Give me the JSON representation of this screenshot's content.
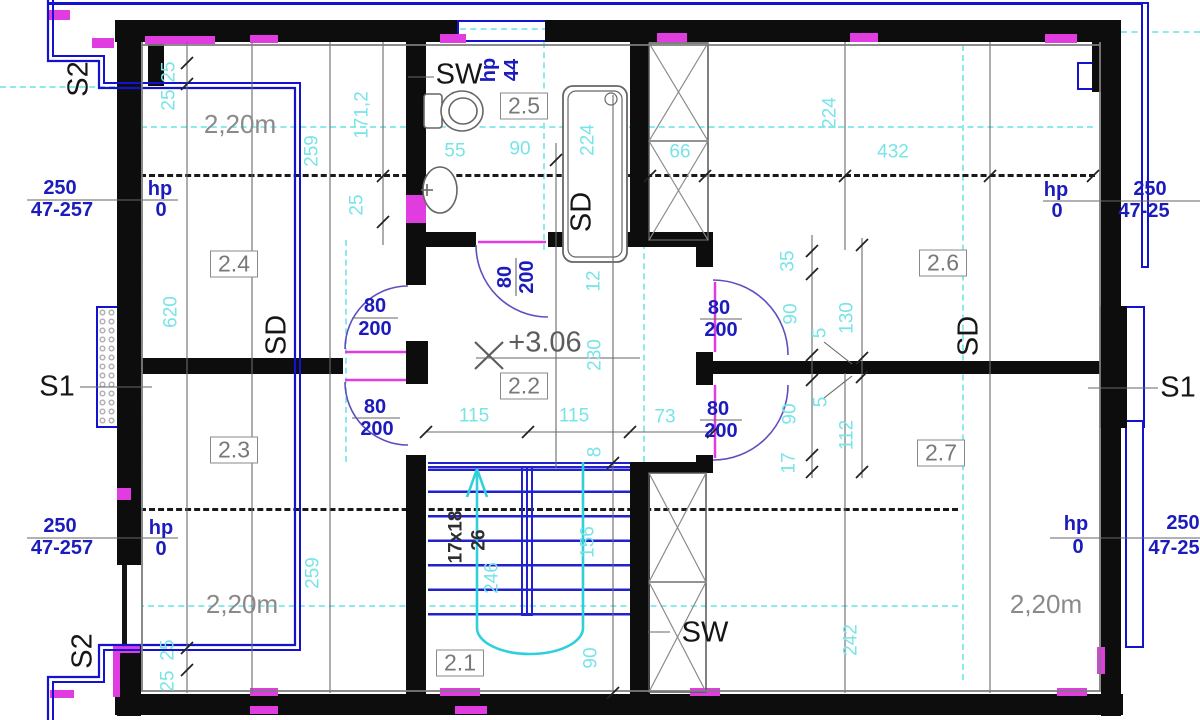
{
  "drawing": {
    "kind": "floor plan (upper storey)",
    "level_marker": "+3.06",
    "stair_note": "17x18",
    "stair_going": "26"
  },
  "rooms": [
    {
      "id": "2.1"
    },
    {
      "id": "2.2"
    },
    {
      "id": "2.3"
    },
    {
      "id": "2.4"
    },
    {
      "id": "2.5"
    },
    {
      "id": "2.6"
    },
    {
      "id": "2.7"
    }
  ],
  "section_markers": {
    "s1": "S1",
    "s2": "S2"
  },
  "wall_labels": {
    "sw": "SW",
    "sd": "SD"
  },
  "colors": {
    "wall": "#0d0d0d",
    "dim_cyan": "#79e4e8",
    "blue_text": "#1c1cbc",
    "magenta": "#e03ce0",
    "door_arc": "#5d4fc0",
    "gray_text": "#8a8a8a",
    "walkline": "#2fd0dc",
    "window_blue": "#1313cf"
  },
  "labels": [
    {
      "n": "dim-label",
      "t": "25",
      "x": 169,
      "y": 72,
      "r": -90,
      "c": "dim"
    },
    {
      "n": "dim-label",
      "t": "25",
      "x": 169,
      "y": 100,
      "r": -90,
      "c": "dim"
    },
    {
      "n": "dim-label",
      "t": "171,2",
      "x": 362,
      "y": 115,
      "r": -90,
      "c": "dim"
    },
    {
      "n": "dim-label",
      "t": "25",
      "x": 357,
      "y": 205,
      "r": -90,
      "c": "dim"
    },
    {
      "n": "dim-label",
      "t": "259",
      "x": 312,
      "y": 151,
      "r": -90,
      "c": "dim"
    },
    {
      "n": "dim-label",
      "t": "620",
      "x": 171,
      "y": 312,
      "r": -90,
      "c": "dim"
    },
    {
      "n": "dim-label",
      "t": "259",
      "x": 313,
      "y": 573,
      "r": -90,
      "c": "dim"
    },
    {
      "n": "dim-label",
      "t": "25",
      "x": 168,
      "y": 650,
      "r": -90,
      "c": "dim"
    },
    {
      "n": "dim-label",
      "t": "25",
      "x": 168,
      "y": 681,
      "r": -90,
      "c": "dim"
    },
    {
      "n": "dim-label",
      "t": "55",
      "x": 455,
      "y": 151,
      "r": 0,
      "c": "dim"
    },
    {
      "n": "dim-label",
      "t": "90",
      "x": 520,
      "y": 149,
      "r": 0,
      "c": "dim"
    },
    {
      "n": "dim-label",
      "t": "224",
      "x": 588,
      "y": 140,
      "r": -90,
      "c": "dim"
    },
    {
      "n": "dim-label",
      "t": "66",
      "x": 680,
      "y": 152,
      "r": 0,
      "c": "dim"
    },
    {
      "n": "dim-label",
      "t": "224",
      "x": 830,
      "y": 113,
      "r": -90,
      "c": "dim"
    },
    {
      "n": "dim-label",
      "t": "432",
      "x": 893,
      "y": 152,
      "r": 0,
      "c": "dim"
    },
    {
      "n": "dim-label",
      "t": "12",
      "x": 594,
      "y": 281,
      "r": -90,
      "c": "dim"
    },
    {
      "n": "dim-label",
      "t": "230",
      "x": 595,
      "y": 355,
      "r": -90,
      "c": "dim"
    },
    {
      "n": "dim-label",
      "t": "8",
      "x": 595,
      "y": 452,
      "r": -90,
      "c": "dim"
    },
    {
      "n": "dim-label",
      "t": "115",
      "x": 474,
      "y": 416,
      "r": 0,
      "c": "dim"
    },
    {
      "n": "dim-label",
      "t": "115",
      "x": 574,
      "y": 416,
      "r": 0,
      "c": "dim"
    },
    {
      "n": "dim-label",
      "t": "73",
      "x": 665,
      "y": 417,
      "r": 0,
      "c": "dim"
    },
    {
      "n": "dim-label",
      "t": "35",
      "x": 788,
      "y": 261,
      "r": -90,
      "c": "dim"
    },
    {
      "n": "dim-label",
      "t": "90",
      "x": 791,
      "y": 314,
      "r": -90,
      "c": "dim"
    },
    {
      "n": "dim-label",
      "t": "5",
      "x": 820,
      "y": 333,
      "r": -90,
      "c": "dim"
    },
    {
      "n": "dim-label",
      "t": "130",
      "x": 847,
      "y": 318,
      "r": -90,
      "c": "dim"
    },
    {
      "n": "dim-label",
      "t": "5",
      "x": 821,
      "y": 402,
      "r": -90,
      "c": "dim"
    },
    {
      "n": "dim-label",
      "t": "90",
      "x": 790,
      "y": 414,
      "r": -90,
      "c": "dim"
    },
    {
      "n": "dim-label",
      "t": "112",
      "x": 847,
      "y": 435,
      "r": -90,
      "c": "dim"
    },
    {
      "n": "dim-label",
      "t": "17",
      "x": 789,
      "y": 463,
      "r": -90,
      "c": "dim"
    },
    {
      "n": "dim-label",
      "t": "242",
      "x": 851,
      "y": 640,
      "r": -90,
      "c": "dim"
    },
    {
      "n": "dim-label",
      "t": "246",
      "x": 492,
      "y": 578,
      "r": -90,
      "c": "dim"
    },
    {
      "n": "dim-label",
      "t": "156",
      "x": 588,
      "y": 542,
      "r": -90,
      "c": "dim"
    },
    {
      "n": "dim-label",
      "t": "90",
      "x": 591,
      "y": 658,
      "r": -90,
      "c": "dim"
    },
    {
      "n": "headroom-label",
      "t": "2,20m",
      "x": 240,
      "y": 124,
      "r": 0,
      "c": "gray"
    },
    {
      "n": "headroom-label",
      "t": "2,20m",
      "x": 242,
      "y": 604,
      "r": 0,
      "c": "gray"
    },
    {
      "n": "headroom-label",
      "t": "2,20m",
      "x": 1046,
      "y": 604,
      "r": 0,
      "c": "gray"
    },
    {
      "n": "level-marker",
      "t": "+3.06",
      "x": 545,
      "y": 343,
      "r": 0,
      "c": "lvl"
    },
    {
      "n": "room-label",
      "t": "2.1",
      "x": 460,
      "y": 663,
      "r": 0,
      "c": "room"
    },
    {
      "n": "room-label",
      "t": "2.2",
      "x": 524,
      "y": 386,
      "r": 0,
      "c": "room"
    },
    {
      "n": "room-label",
      "t": "2.3",
      "x": 234,
      "y": 450,
      "r": 0,
      "c": "room"
    },
    {
      "n": "room-label",
      "t": "2.4",
      "x": 234,
      "y": 264,
      "r": 0,
      "c": "room"
    },
    {
      "n": "room-label",
      "t": "2.5",
      "x": 524,
      "y": 106,
      "r": 0,
      "c": "room"
    },
    {
      "n": "room-label",
      "t": "2.6",
      "x": 943,
      "y": 263,
      "r": 0,
      "c": "room"
    },
    {
      "n": "room-label",
      "t": "2.7",
      "x": 941,
      "y": 453,
      "r": 0,
      "c": "room"
    },
    {
      "n": "sw-label",
      "t": "SW",
      "x": 459,
      "y": 75,
      "r": 0,
      "c": "blk"
    },
    {
      "n": "sw-label",
      "t": "SW",
      "x": 705,
      "y": 633,
      "r": 0,
      "c": "blk"
    },
    {
      "n": "sd-label",
      "t": "SD",
      "x": 582,
      "y": 212,
      "r": -90,
      "c": "blk"
    },
    {
      "n": "sd-label",
      "t": "SD",
      "x": 277,
      "y": 335,
      "r": -90,
      "c": "blk"
    },
    {
      "n": "sd-label",
      "t": "SD",
      "x": 969,
      "y": 336,
      "r": -90,
      "c": "blk"
    },
    {
      "n": "section-s1-label",
      "t": "S1",
      "x": 57,
      "y": 387,
      "r": 0,
      "c": "blk"
    },
    {
      "n": "section-s1-label",
      "t": "S1",
      "x": 1178,
      "y": 388,
      "r": 0,
      "c": "blk"
    },
    {
      "n": "section-s2-label",
      "t": "S2",
      "x": 79,
      "y": 79,
      "r": -90,
      "c": "blk"
    },
    {
      "n": "section-s2-label",
      "t": "S2",
      "x": 83,
      "y": 651,
      "r": -90,
      "c": "blk"
    },
    {
      "n": "stair-riser-label",
      "t": "17x18",
      "x": 456,
      "y": 537,
      "r": -90,
      "c": "blksm"
    },
    {
      "n": "stair-going-label",
      "t": "26",
      "x": 479,
      "y": 540,
      "r": -90,
      "c": "blksm"
    },
    {
      "n": "window-label",
      "t": "250",
      "x": 60,
      "y": 188,
      "r": 0,
      "c": "blue"
    },
    {
      "n": "window-label",
      "t": "47-257",
      "x": 62,
      "y": 210,
      "r": 0,
      "c": "blue"
    },
    {
      "n": "parapet-label",
      "t": "hp",
      "x": 160,
      "y": 189,
      "r": 0,
      "c": "blue"
    },
    {
      "n": "parapet-label",
      "t": "0",
      "x": 161,
      "y": 210,
      "r": 0,
      "c": "blue"
    },
    {
      "n": "window-label",
      "t": "250",
      "x": 60,
      "y": 526,
      "r": 0,
      "c": "blue"
    },
    {
      "n": "window-label",
      "t": "47-257",
      "x": 62,
      "y": 548,
      "r": 0,
      "c": "blue"
    },
    {
      "n": "parapet-label",
      "t": "hp",
      "x": 161,
      "y": 528,
      "r": 0,
      "c": "blue"
    },
    {
      "n": "parapet-label",
      "t": "0",
      "x": 161,
      "y": 549,
      "r": 0,
      "c": "blue"
    },
    {
      "n": "parapet-label",
      "t": "hp",
      "x": 1056,
      "y": 190,
      "r": 0,
      "c": "blue"
    },
    {
      "n": "parapet-label",
      "t": "0",
      "x": 1057,
      "y": 211,
      "r": 0,
      "c": "blue"
    },
    {
      "n": "window-label",
      "t": "250",
      "x": 1150,
      "y": 189,
      "r": 0,
      "c": "blue"
    },
    {
      "n": "window-label",
      "t": "47-25",
      "x": 1144,
      "y": 211,
      "r": 0,
      "c": "blue"
    },
    {
      "n": "parapet-label",
      "t": "hp",
      "x": 1076,
      "y": 524,
      "r": 0,
      "c": "blue"
    },
    {
      "n": "parapet-label",
      "t": "0",
      "x": 1078,
      "y": 547,
      "r": 0,
      "c": "blue"
    },
    {
      "n": "window-label",
      "t": "250",
      "x": 1183,
      "y": 523,
      "r": 0,
      "c": "blue"
    },
    {
      "n": "window-label",
      "t": "47-25",
      "x": 1174,
      "y": 548,
      "r": 0,
      "c": "blue"
    },
    {
      "n": "parapet-label",
      "t": "hp",
      "x": 489,
      "y": 70,
      "r": -90,
      "c": "blue"
    },
    {
      "n": "parapet-label",
      "t": "44",
      "x": 512,
      "y": 70,
      "r": -90,
      "c": "blue"
    },
    {
      "n": "door-size-label",
      "t": "80",
      "x": 375,
      "y": 306,
      "r": 0,
      "c": "blue"
    },
    {
      "n": "door-size-label",
      "t": "200",
      "x": 375,
      "y": 329,
      "r": 0,
      "c": "blue"
    },
    {
      "n": "door-size-label",
      "t": "80",
      "x": 375,
      "y": 407,
      "r": 0,
      "c": "blue"
    },
    {
      "n": "door-size-label",
      "t": "200",
      "x": 377,
      "y": 429,
      "r": 0,
      "c": "blue"
    },
    {
      "n": "door-size-label",
      "t": "80",
      "x": 719,
      "y": 308,
      "r": 0,
      "c": "blue"
    },
    {
      "n": "door-size-label",
      "t": "200",
      "x": 721,
      "y": 330,
      "r": 0,
      "c": "blue"
    },
    {
      "n": "door-size-label",
      "t": "80",
      "x": 718,
      "y": 409,
      "r": 0,
      "c": "blue"
    },
    {
      "n": "door-size-label",
      "t": "200",
      "x": 721,
      "y": 431,
      "r": 0,
      "c": "blue"
    },
    {
      "n": "door-size-label",
      "t": "80",
      "x": 505,
      "y": 277,
      "r": -90,
      "c": "blue"
    },
    {
      "n": "door-size-label",
      "t": "200",
      "x": 527,
      "y": 277,
      "r": -90,
      "c": "blue"
    }
  ]
}
